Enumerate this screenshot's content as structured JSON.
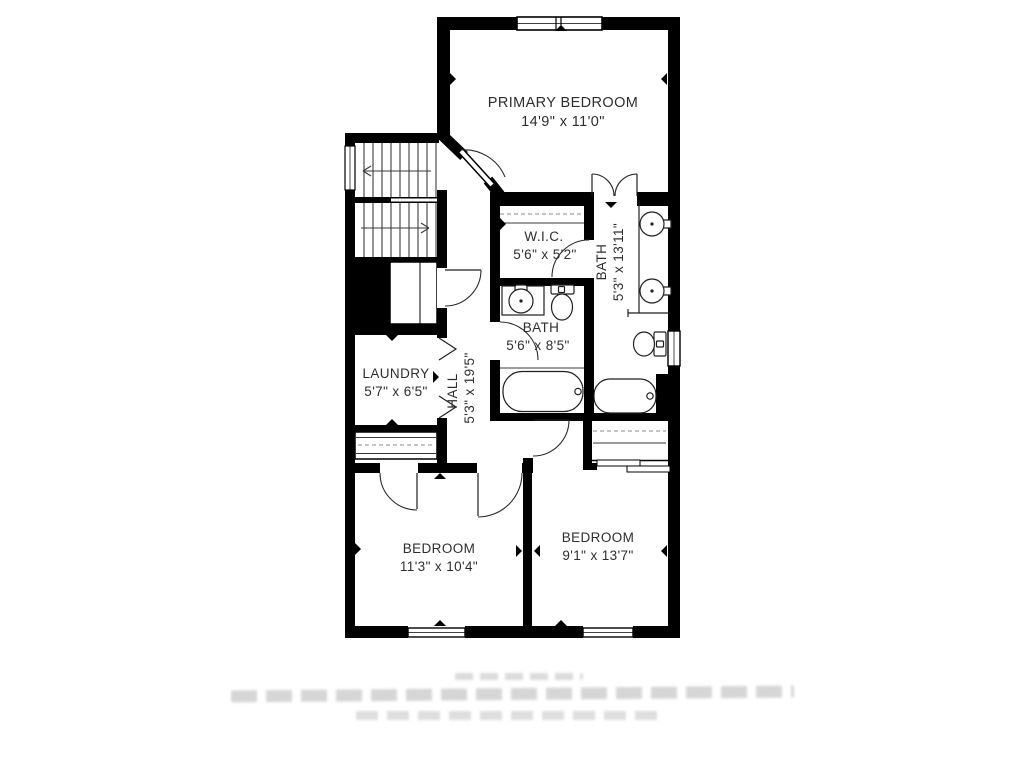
{
  "floor_plan": {
    "rooms": [
      {
        "id": "primary-bedroom",
        "name": "PRIMARY BEDROOM",
        "dims": "14'9\" x 11'0\""
      },
      {
        "id": "wic",
        "name": "W.I.C.",
        "dims": "5'6\" x 5'2\""
      },
      {
        "id": "primary-bath",
        "name": "BATH",
        "dims": "5'3\" x 13'11\"",
        "label_rotated": true
      },
      {
        "id": "hall-bath",
        "name": "BATH",
        "dims": "5'6\" x 8'5\""
      },
      {
        "id": "laundry",
        "name": "LAUNDRY",
        "dims": "5'7\" x 6'5\""
      },
      {
        "id": "hall",
        "name": "HALL",
        "dims": "5'3\" x 19'5\"",
        "label_rotated": true
      },
      {
        "id": "bedroom-left",
        "name": "BEDROOM",
        "dims": "11'3\" x 10'4\""
      },
      {
        "id": "bedroom-right",
        "name": "BEDROOM",
        "dims": "9'1\" x 13'7\""
      }
    ],
    "features": {
      "stairs": "two flights with direction arrows",
      "fixtures": [
        "double-sink-vanity",
        "toilet",
        "bathtub",
        "sink-vanity",
        "toilet",
        "bathtub",
        "under-stair-cabinet"
      ],
      "closets": [
        "wic-rod",
        "laundry-hall-closet",
        "bedroom-right-closet-sliding"
      ],
      "window_count": 5
    },
    "colors": {
      "walls": "#000000",
      "background": "#ffffff",
      "labels": "#2e2e2e"
    }
  },
  "footer": {
    "disclaimer_legible": false,
    "blurred_line_count": 3
  }
}
